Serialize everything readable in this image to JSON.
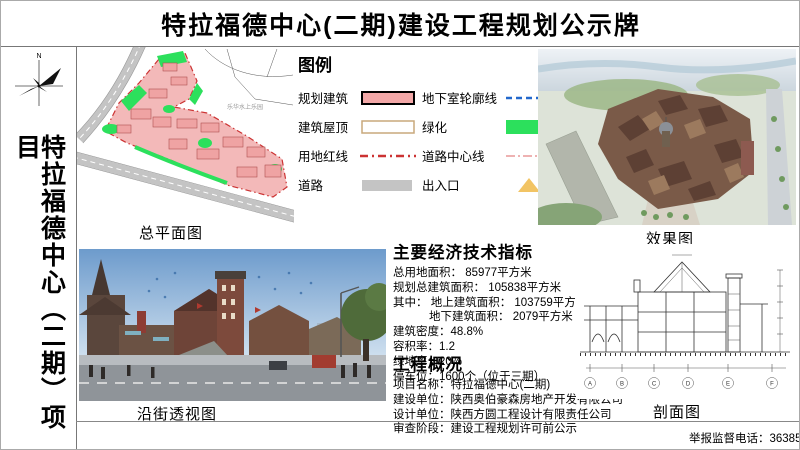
{
  "header": {
    "title": "特拉福德中心(二期)建设工程规划公示牌"
  },
  "sidebar": {
    "compass_label": "N",
    "project_name": "特拉福德中心（二期）项目"
  },
  "legend": {
    "title": "图例",
    "items": [
      {
        "label": "规划建筑",
        "swatch": "pink-filled-rect"
      },
      {
        "label": "地下室轮廓线",
        "swatch": "blue-dashed-line"
      },
      {
        "label": "建筑屋顶",
        "swatch": "white-rect-tan-border"
      },
      {
        "label": "绿化",
        "swatch": "green-filled-rect"
      },
      {
        "label": "用地红线",
        "swatch": "red-dash-dot-line"
      },
      {
        "label": "道路中心线",
        "swatch": "pink-dash-dot-line"
      },
      {
        "label": "道路",
        "swatch": "gray-filled-rect"
      },
      {
        "label": "出入口",
        "swatch": "yellow-triangle"
      }
    ]
  },
  "panels": {
    "site_plan_label": "总平面图",
    "rendering_label": "效果图",
    "street_view_label": "沿街透视图",
    "section_label": "剖面图"
  },
  "site_plan": {
    "annotation": "乐华水上乐园"
  },
  "indicators": {
    "title": "主要经济技术指标",
    "lines": [
      "总用地面积：  85977平方米",
      "规划总建筑面积：  105838平方米",
      "其中： 地上建筑面积：  103759平方米",
      "地下建筑面积：  2079平方米",
      "建筑密度：48.8%",
      "容积率：1.2",
      "绿地率：20%",
      "停车位：1600个（位于三期）"
    ]
  },
  "overview": {
    "title": "工程概况",
    "lines": [
      "项目名称：特拉福德中心(二期)",
      "建设单位：陕西奥伯豪森房地产开发有限公司",
      "设计单位：陕西方圆工程设计有限责任公司",
      "审查阶段：建设工程规划许可前公示"
    ]
  },
  "section_drawing": {
    "grid_labels": [
      "A",
      "B",
      "C",
      "D",
      "E",
      "F"
    ]
  },
  "footer": {
    "hotline": "举报监督电话：36385538"
  },
  "colors": {
    "planned_building": "#f3a8a8",
    "building_roof_border": "#c9a87c",
    "land_red_line": "#cc3333",
    "road": "#c4c4c4",
    "basement_outline": "#2268cc",
    "greenery": "#2ce05c",
    "road_centerline": "#e89898",
    "entrance_marker": "#f2c464"
  }
}
